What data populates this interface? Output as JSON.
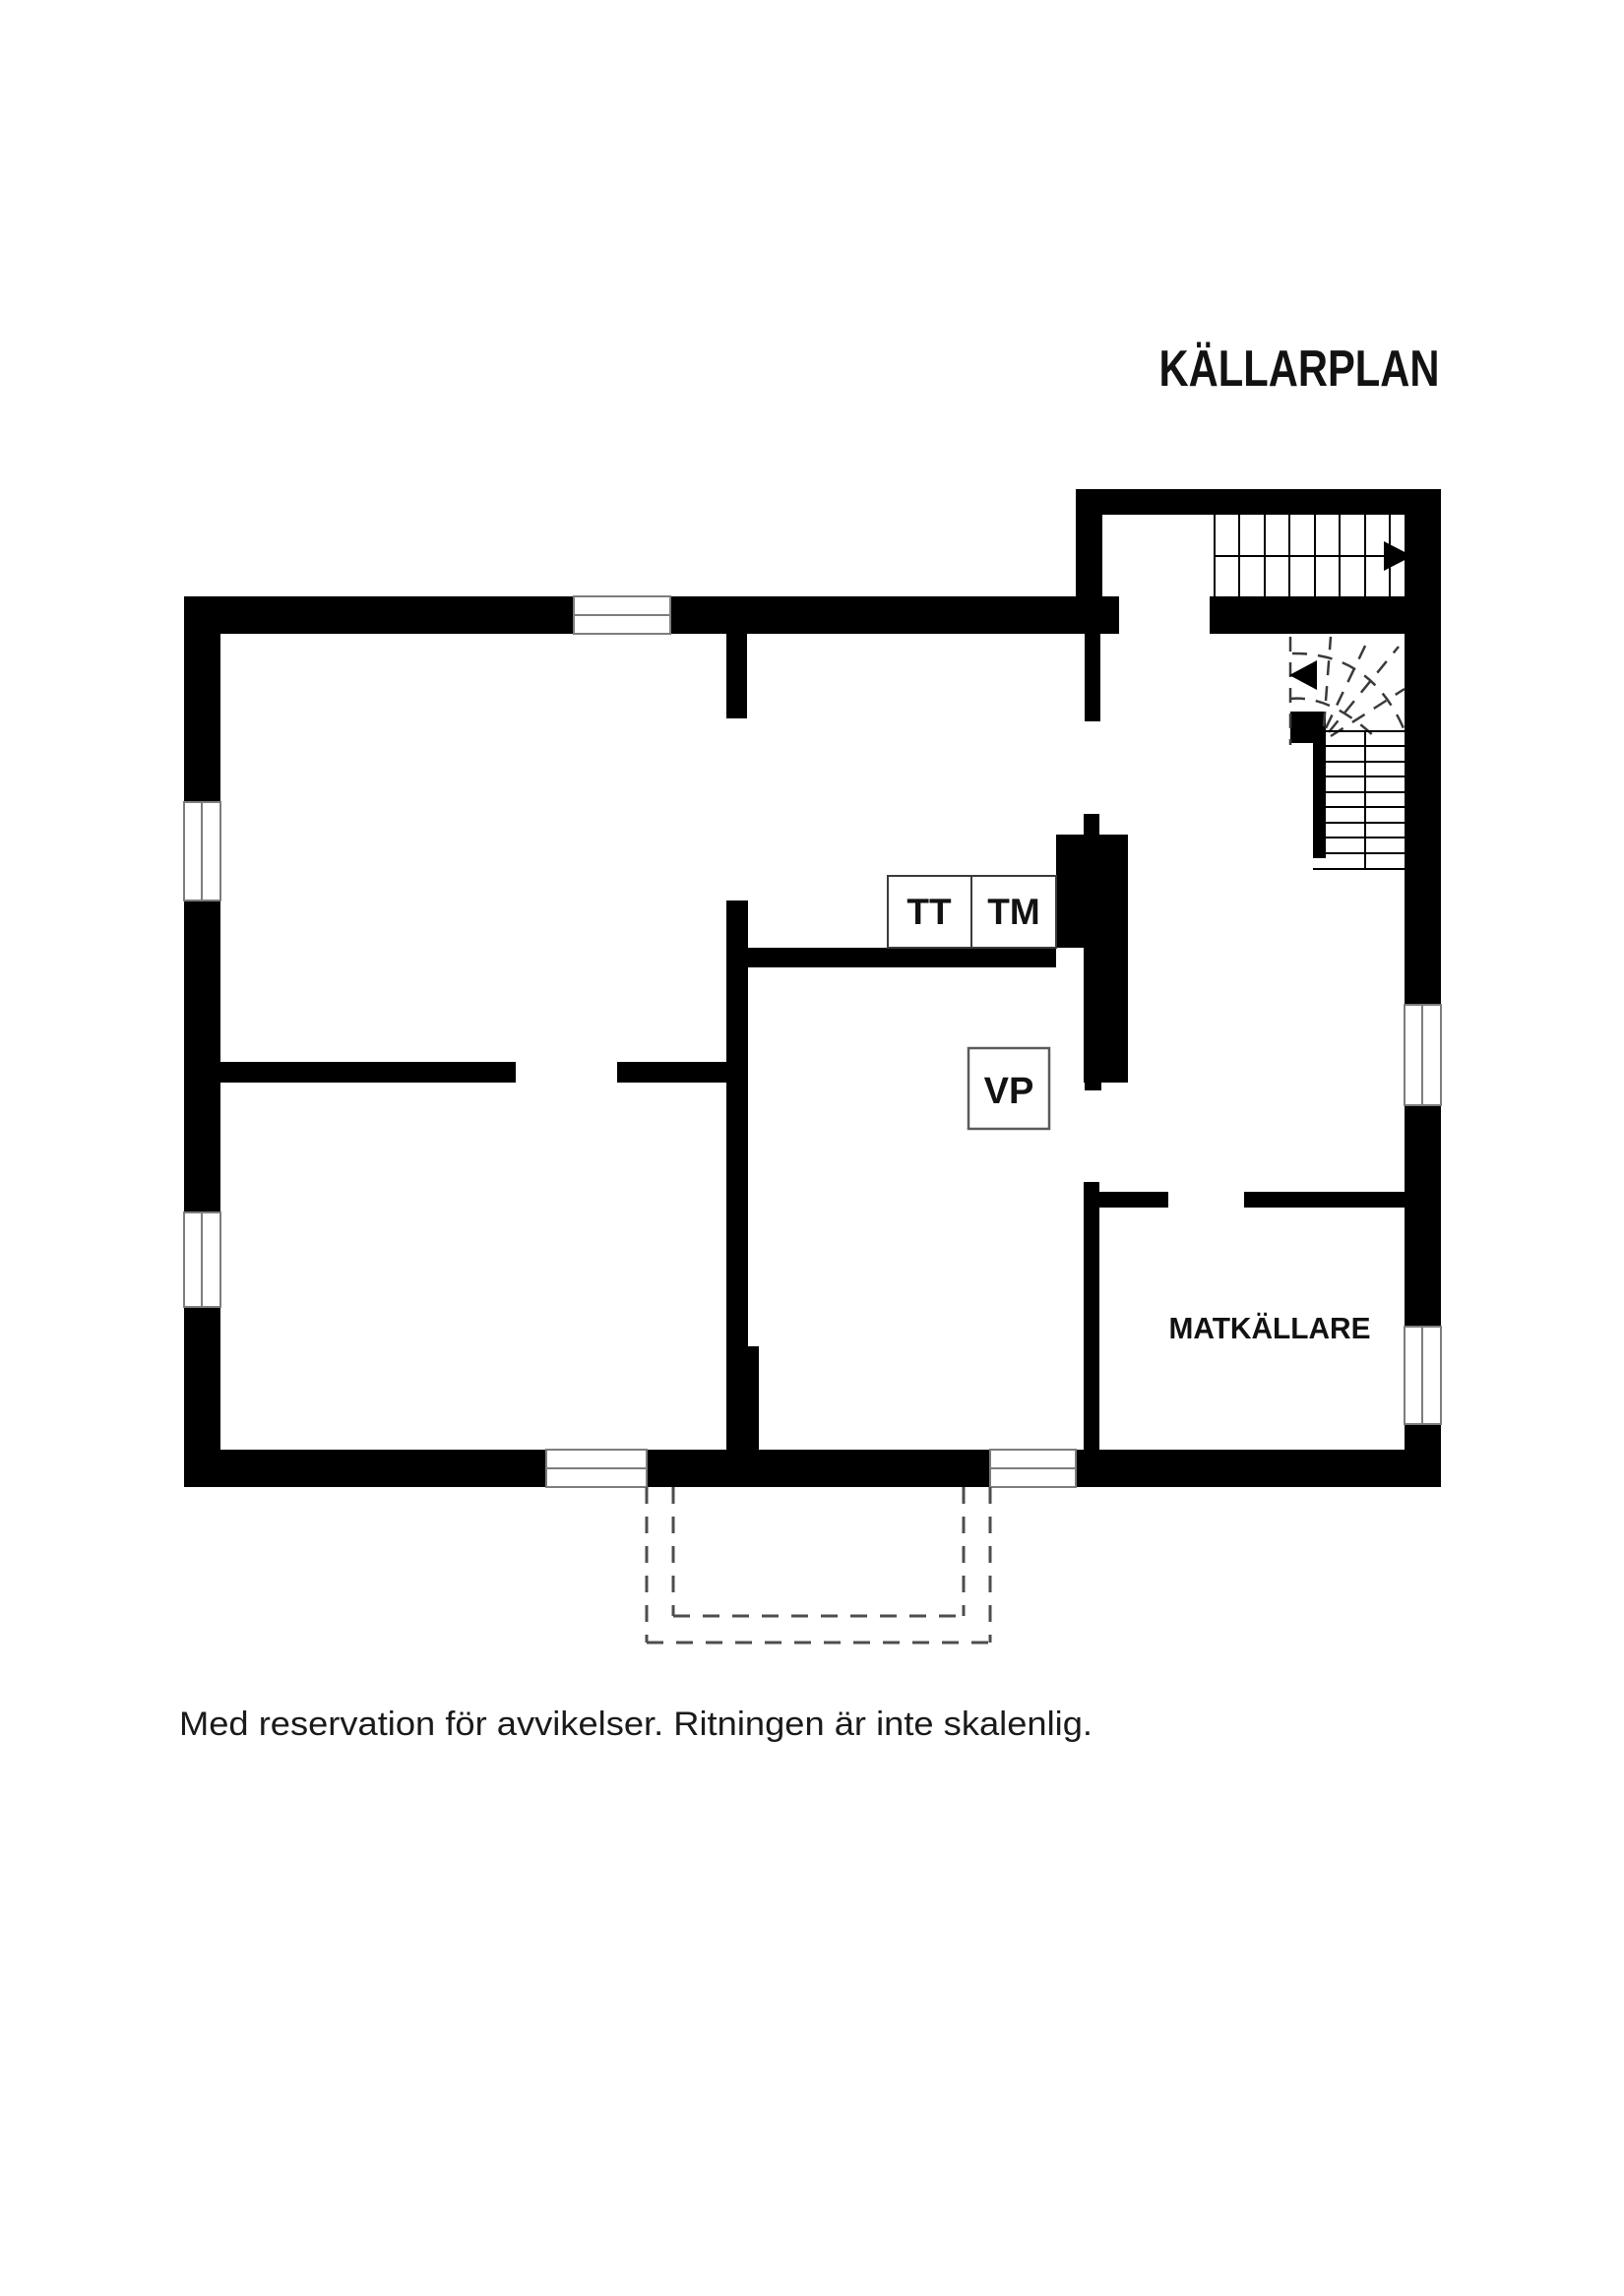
{
  "page": {
    "background": "#ffffff",
    "drawing_color": "#000000"
  },
  "title": {
    "text": "KÄLLARPLAN"
  },
  "rooms": {
    "matkallare_label": "MATKÄLLARE"
  },
  "fixtures": {
    "tt_label": "TT",
    "tm_label": "TM",
    "vp_label": "VP"
  },
  "disclaimer": {
    "text": "Med reservation för avvikelser. Ritningen är inte skalenlig."
  },
  "colors": {
    "wall": "#000000",
    "window_border": "#7d7d7d",
    "winder_dash": "#3a3a3a",
    "exterior_dash": "#4d4d4d",
    "text": "#121212"
  }
}
